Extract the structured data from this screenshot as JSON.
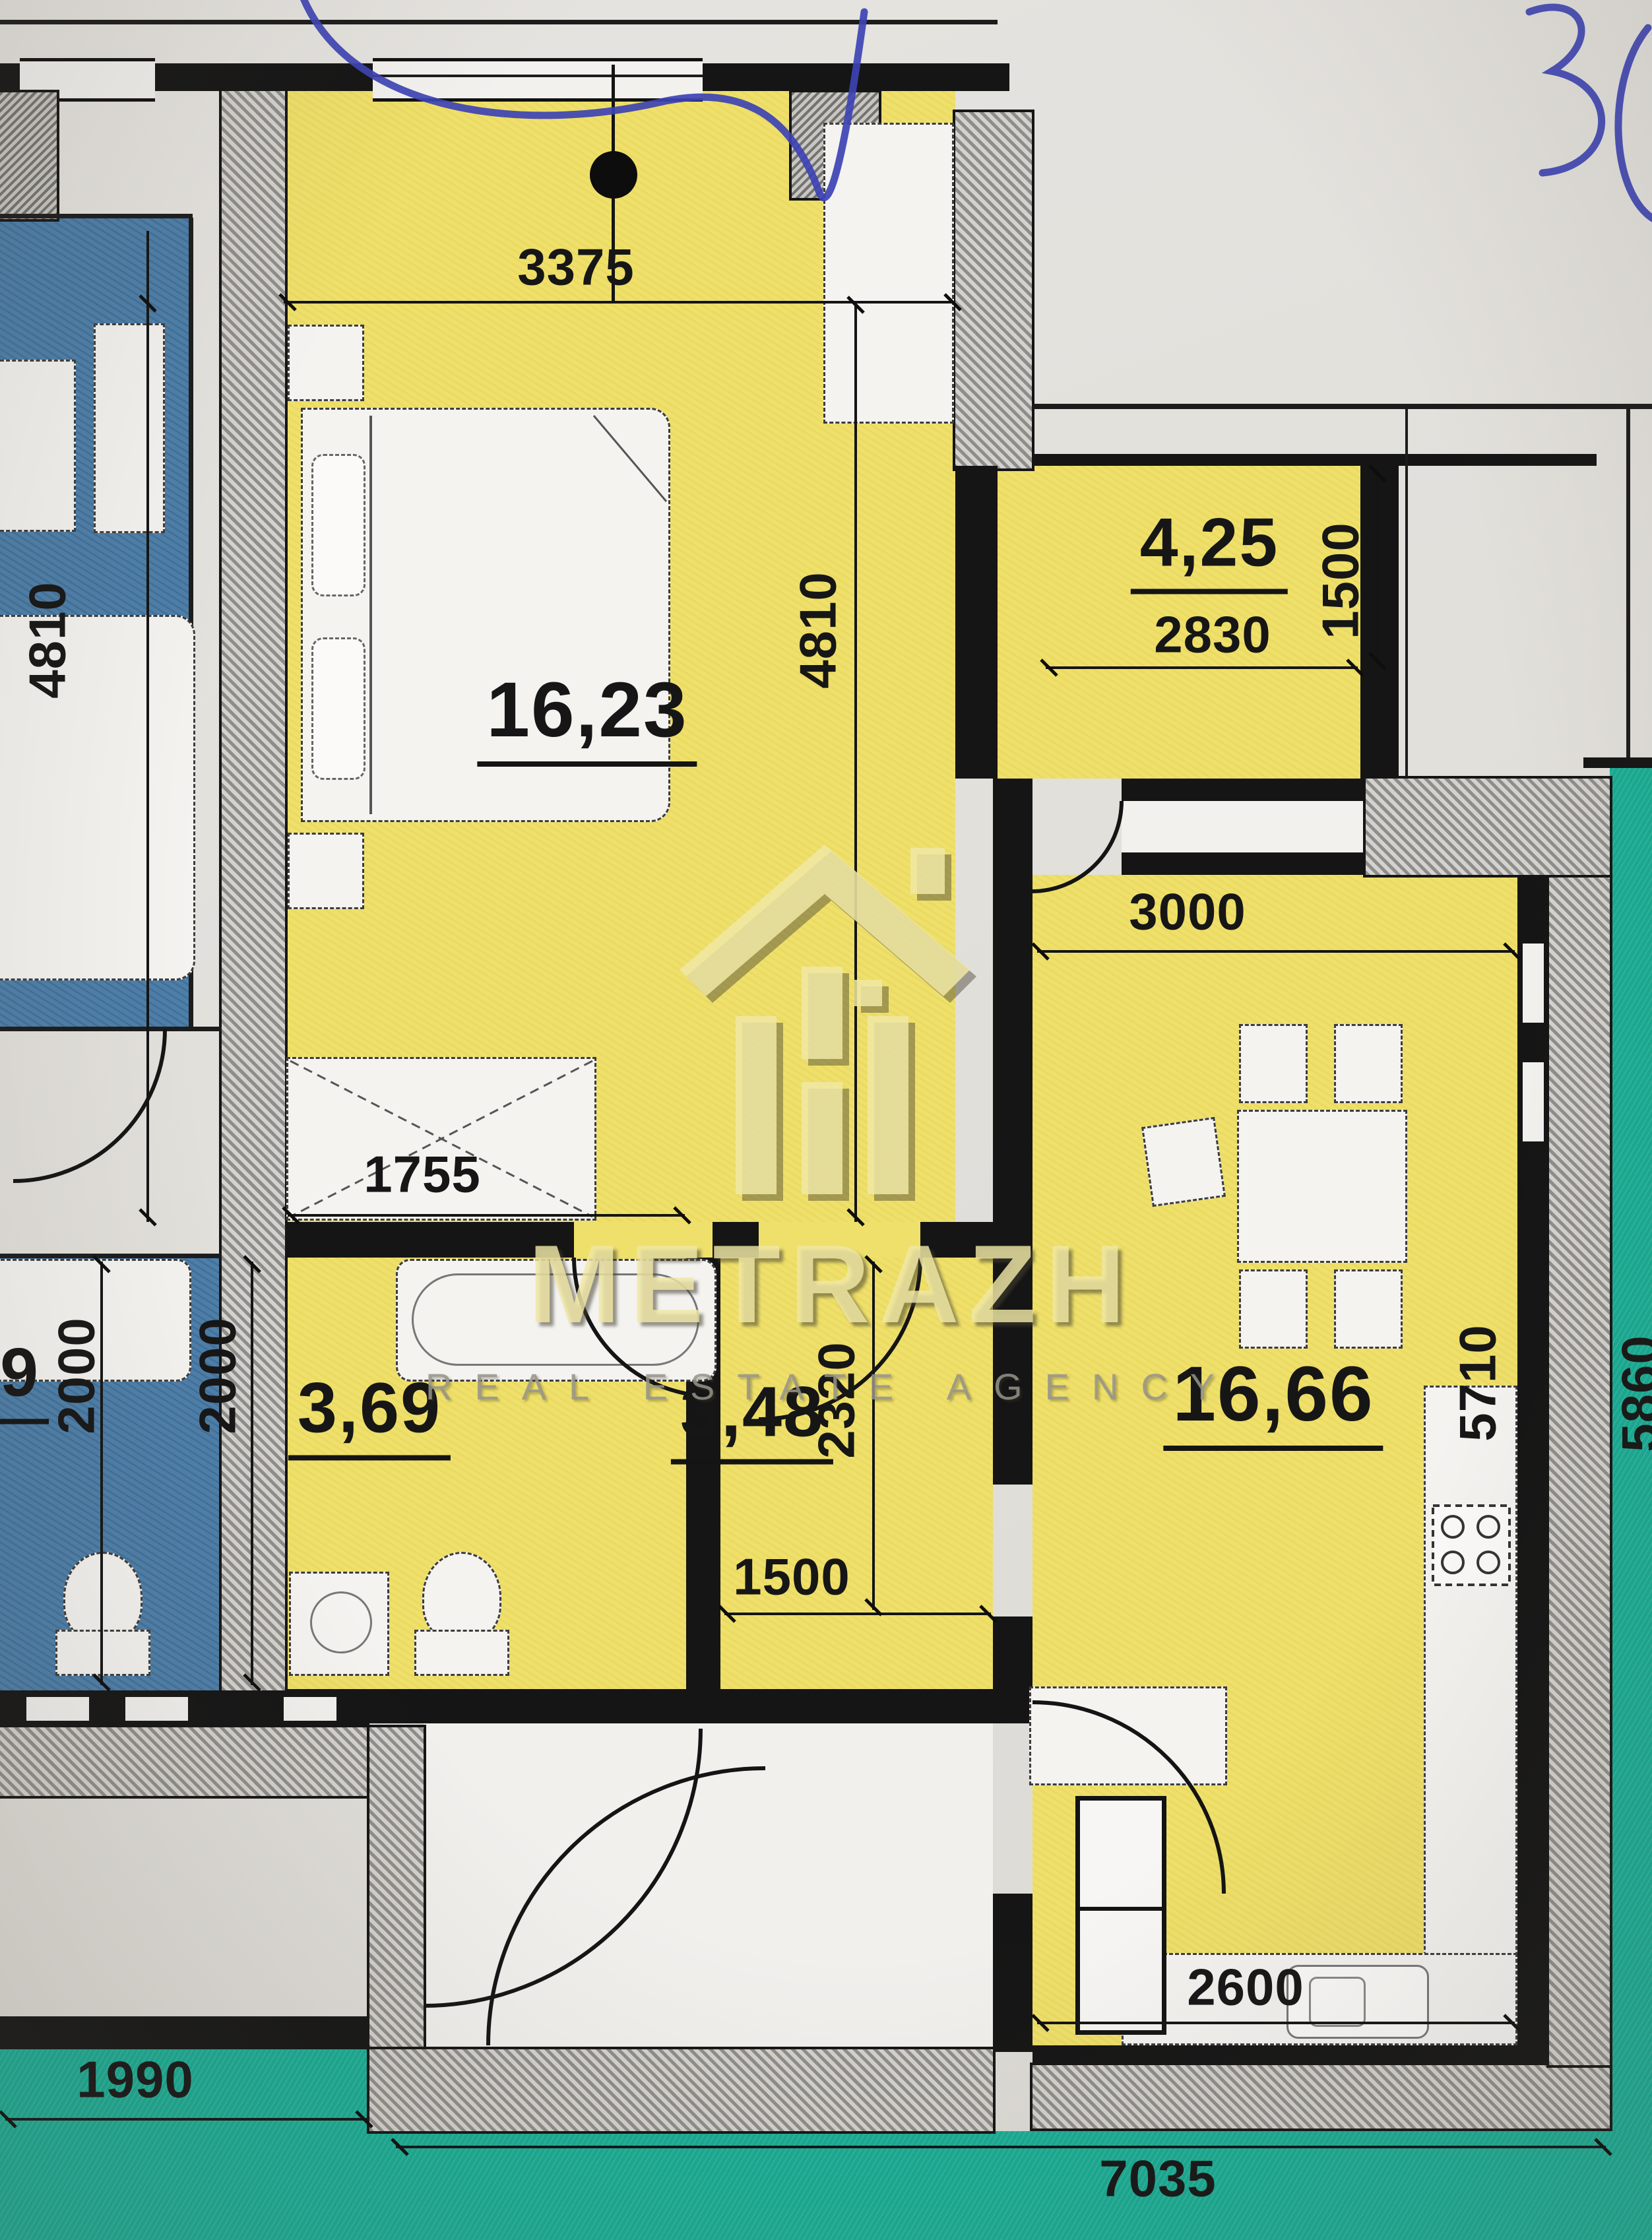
{
  "photo": {
    "handwritten_note": "30"
  },
  "watermark": {
    "brand": "METRAZH",
    "tagline": "REAL ESTATE AGENCY"
  },
  "rooms": {
    "bedroom": {
      "area": "16,23"
    },
    "balcony": {
      "area": "4,25"
    },
    "kitchen_living": {
      "area": "16,66"
    },
    "bathroom": {
      "area": "3,69"
    },
    "hallway": {
      "area": "3,48"
    },
    "neighbor_room": {
      "area": "9"
    }
  },
  "dims": {
    "top_width": "3375",
    "bedroom_height_left": "4810",
    "bedroom_height_right": "4810",
    "balcony_width": "2830",
    "balcony_depth": "1500",
    "kitchen_top_width": "3000",
    "bathroom_width": "1755",
    "neighbor_bath_height": "2000",
    "bathroom_height": "2000",
    "hallway_height": "2320",
    "hallway_width": "1500",
    "kitchen_height": "5710",
    "right_side_total": "5860",
    "kitchen_bottom_width": "2600",
    "bottom_total": "7035",
    "bottom_left": "1990"
  }
}
